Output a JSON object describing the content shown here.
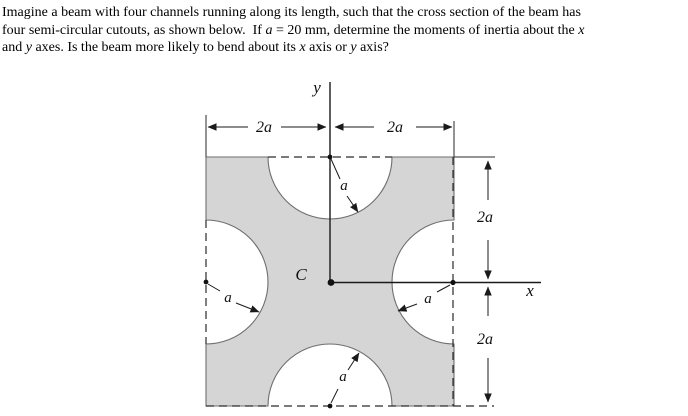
{
  "problem": {
    "lines": [
      [
        {
          "t": "Imagine a beam with four channels running along its length, such that the cross section of the beam has"
        }
      ],
      [
        {
          "t": "four semi-circular cutouts, as shown below.  If "
        },
        {
          "t": "a",
          "i": 1
        },
        {
          "t": " = 20 mm, determine the moments of inertia about the "
        },
        {
          "t": "x",
          "i": 1
        }
      ],
      [
        {
          "t": "and "
        },
        {
          "t": "y",
          "i": 1
        },
        {
          "t": " axes. Is the beam more likely to bend about its "
        },
        {
          "t": "x",
          "i": 1
        },
        {
          "t": " axis or "
        },
        {
          "t": "y",
          "i": 1
        },
        {
          "t": " axis?"
        }
      ]
    ]
  },
  "diagram": {
    "labels": {
      "y_axis": "y",
      "x_axis": "x",
      "centroid": "C",
      "dim_top_left": "2a",
      "dim_top_right": "2a",
      "dim_right_upper": "2a",
      "dim_right_lower": "2a",
      "radius_top": "a",
      "radius_left": "a",
      "radius_right": "a",
      "radius_bottom": "a"
    },
    "colors": {
      "shape_fill": "#d5d5d5",
      "shape_stroke": "#6e6e6e",
      "line_color": "#1a1a1a"
    }
  }
}
